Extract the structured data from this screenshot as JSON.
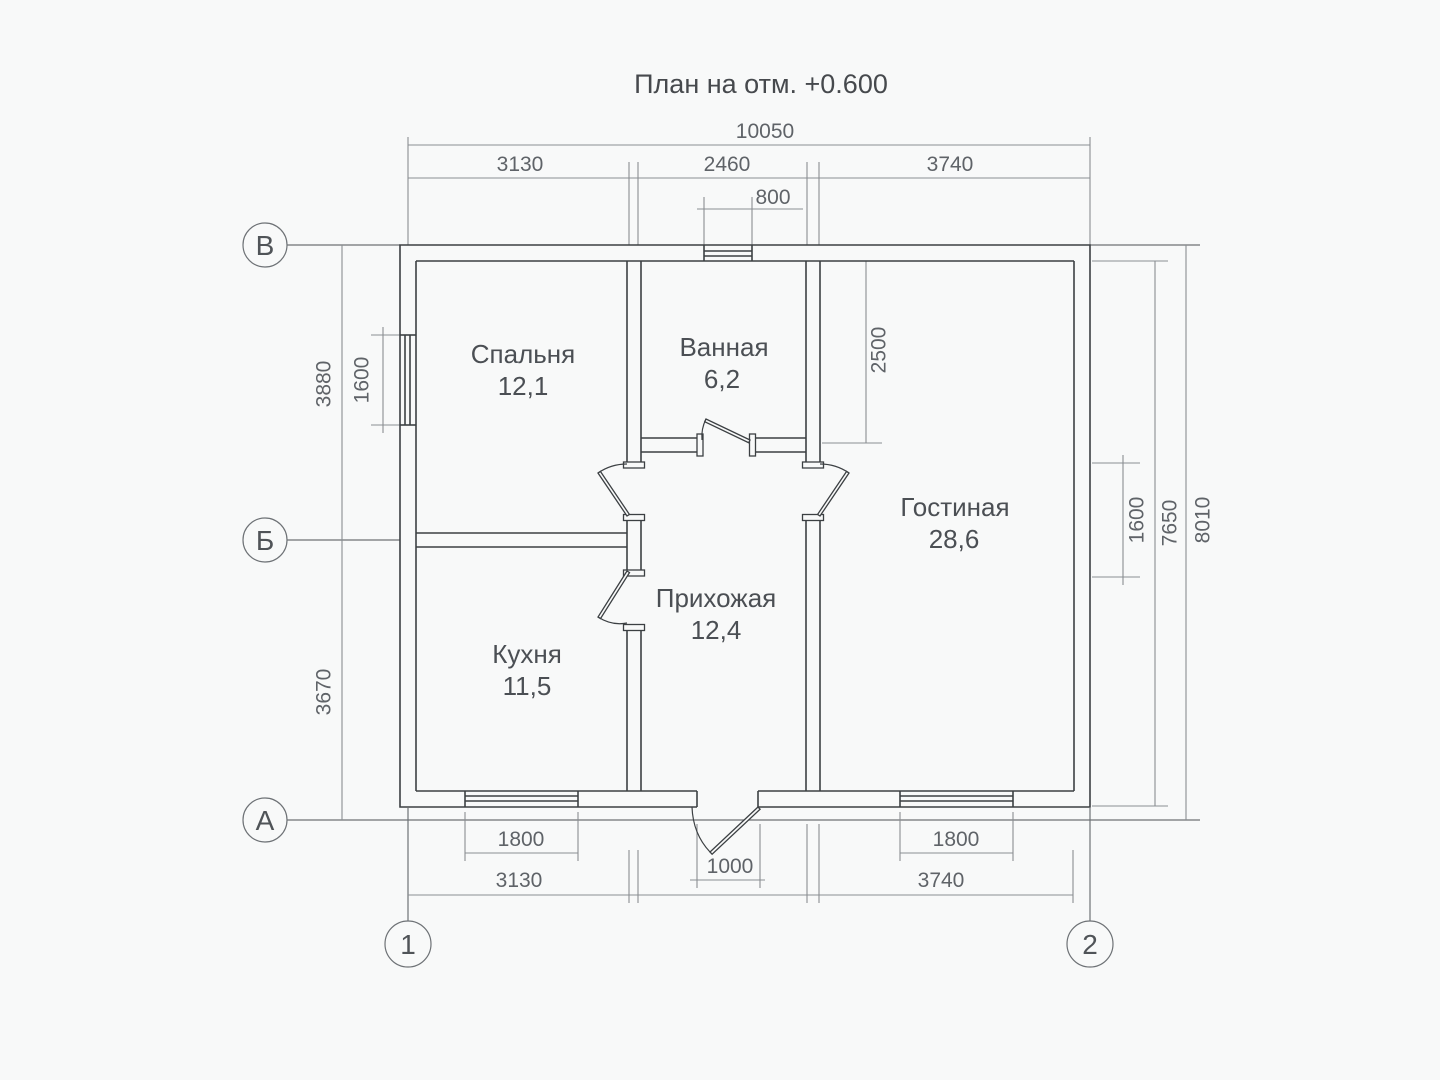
{
  "title": "План на отм. +0.600",
  "axes": {
    "rows": [
      "В",
      "Б",
      "А"
    ],
    "cols": [
      "1",
      "2"
    ]
  },
  "rooms": [
    {
      "name": "Спальня",
      "area": "12,1"
    },
    {
      "name": "Ванная",
      "area": "6,2"
    },
    {
      "name": "Гостиная",
      "area": "28,6"
    },
    {
      "name": "Прихожая",
      "area": "12,4"
    },
    {
      "name": "Кухня",
      "area": "11,5"
    }
  ],
  "dimensions": {
    "top": {
      "overall": "10050",
      "chain": [
        "3130",
        "2460",
        "3740"
      ],
      "window": "800"
    },
    "bottom": {
      "windows": [
        "1800",
        "1800"
      ],
      "door": "1000",
      "chain": [
        "3130",
        "3740"
      ]
    },
    "left": {
      "upper": "3880",
      "lower": "3670",
      "window": "1600"
    },
    "right": {
      "bathroom": "2500",
      "window": "1600",
      "inner": "7650",
      "overall": "8010"
    }
  },
  "colors": {
    "background": "#f8f9f9",
    "walls": "#3c4043",
    "dimensions": "#8a8e92",
    "text": "#5f6368"
  }
}
